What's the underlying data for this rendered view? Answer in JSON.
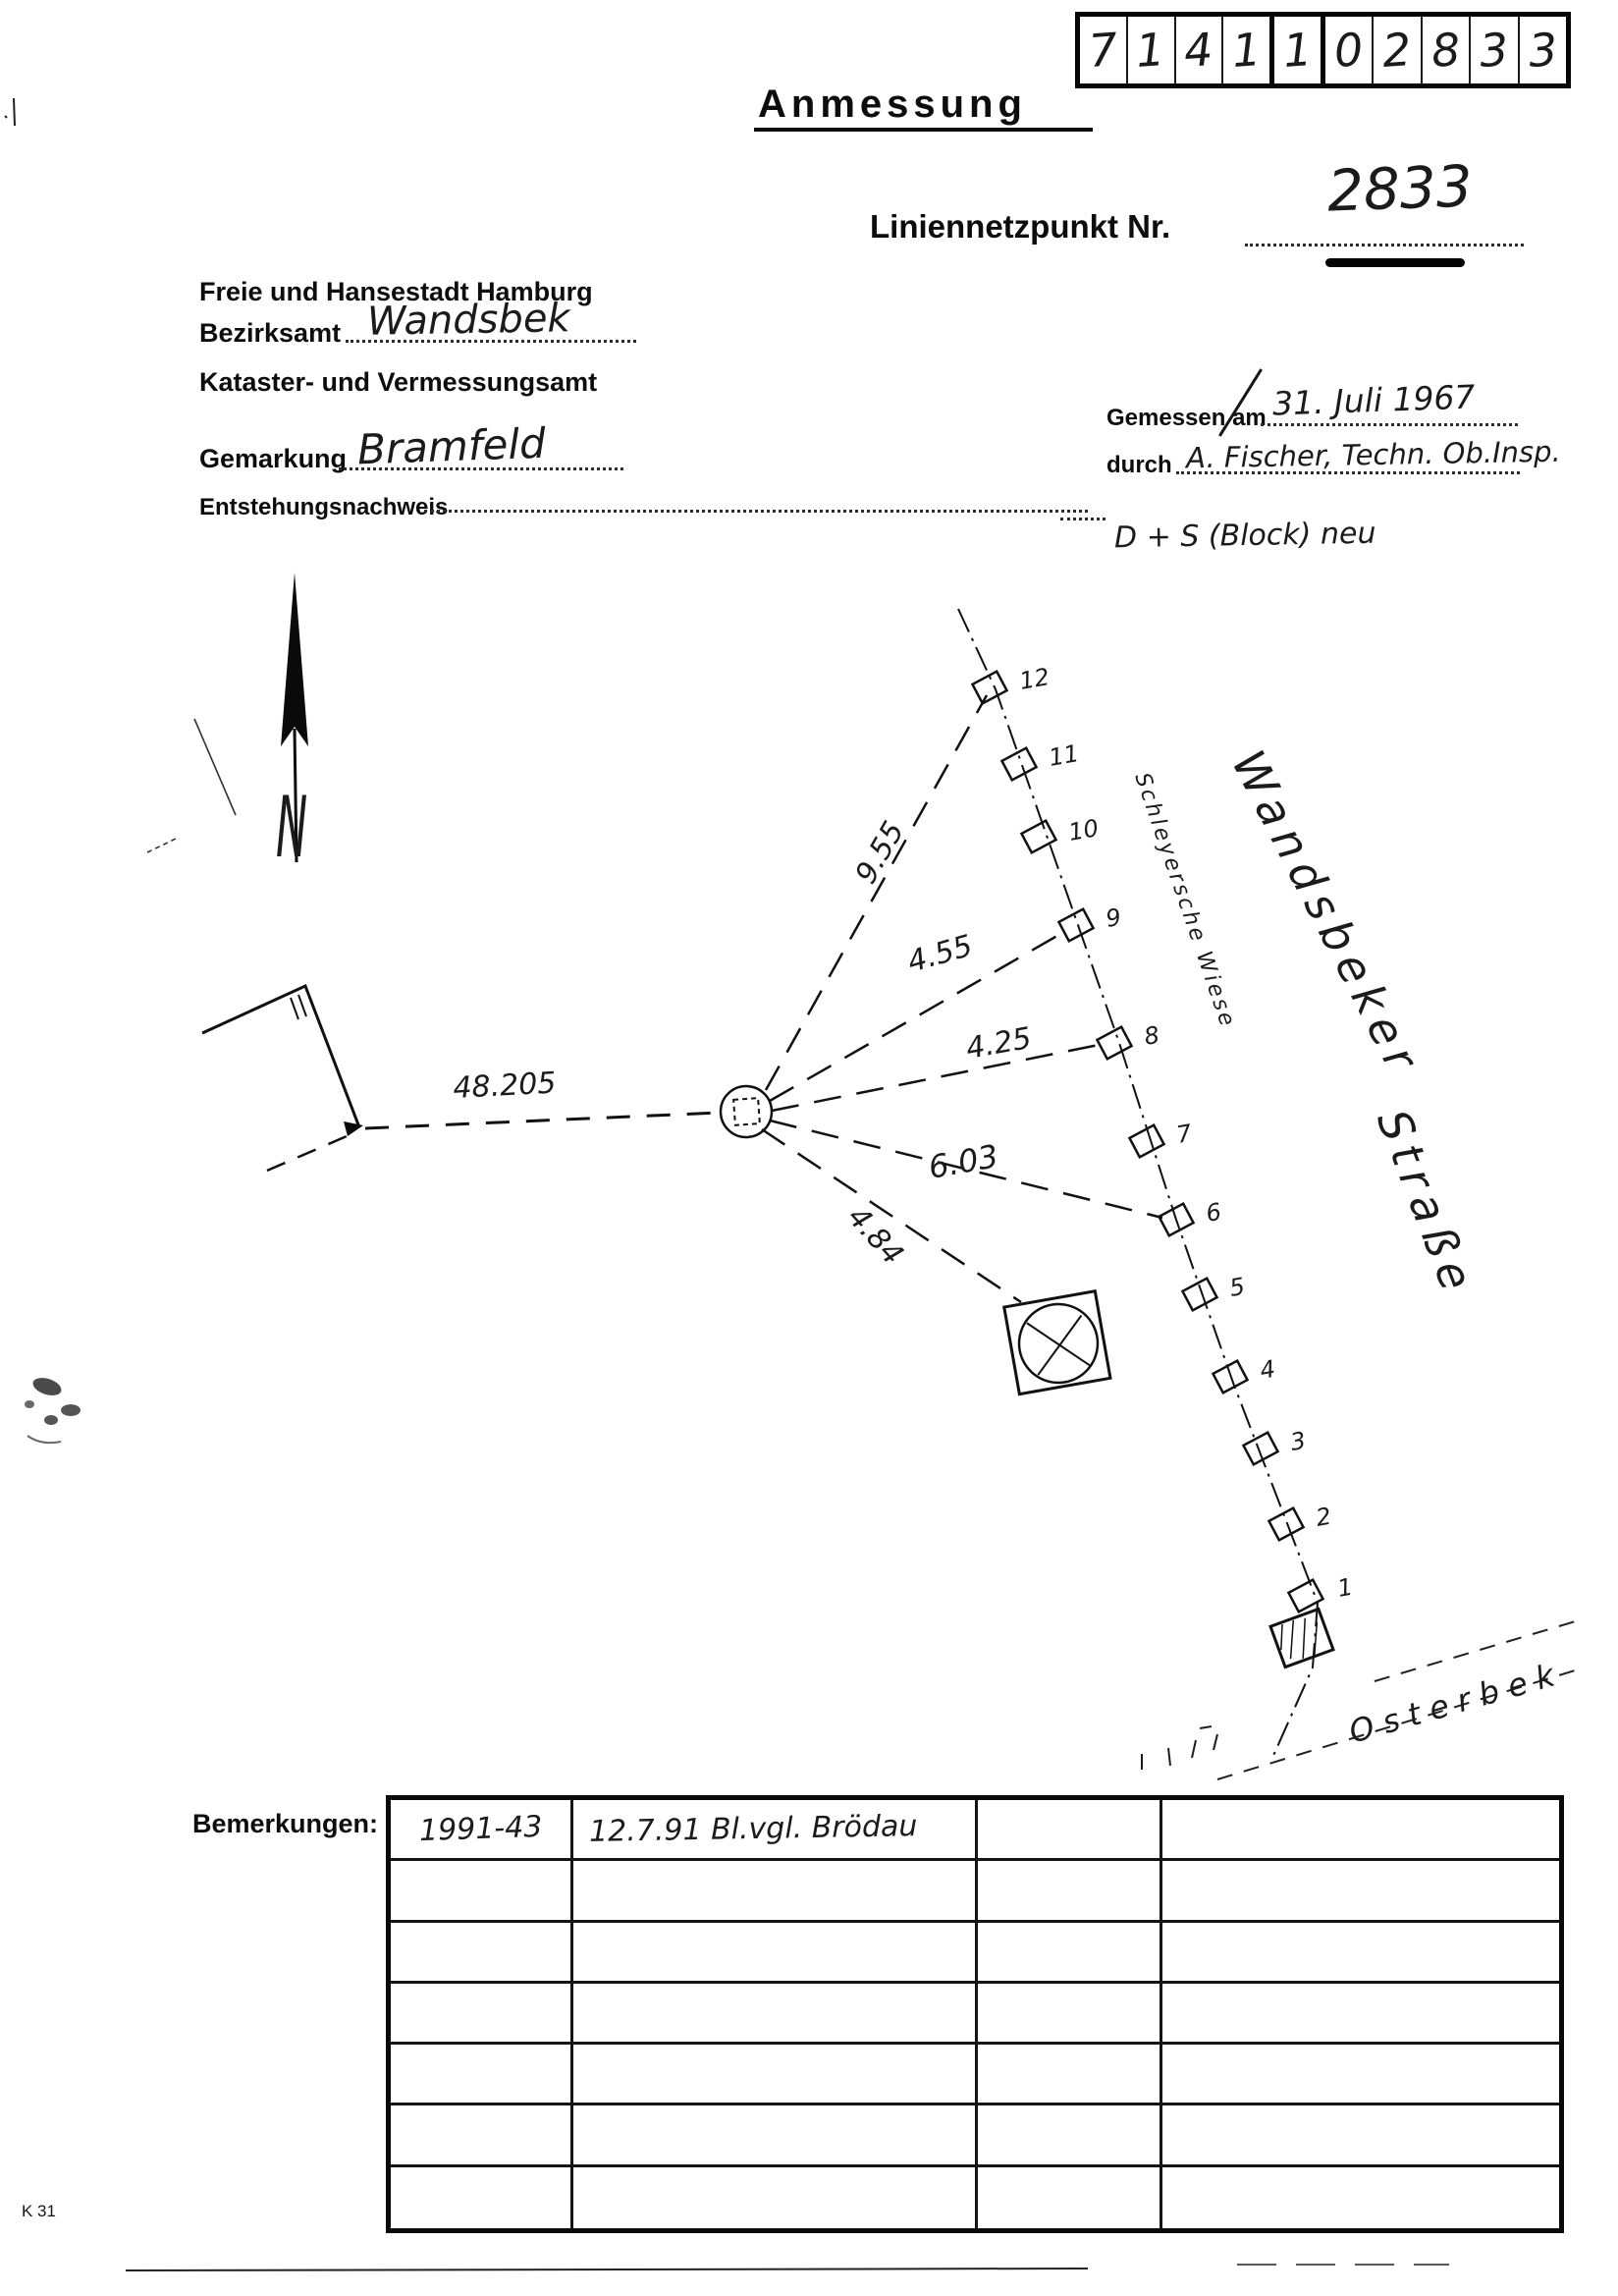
{
  "page": {
    "form_code": "K 31"
  },
  "header": {
    "title": "Anmessung",
    "id_boxes": {
      "group1": [
        "7",
        "1",
        "4",
        "1"
      ],
      "group2": [
        "1"
      ],
      "group3": [
        "0",
        "2",
        "8",
        "3",
        "3"
      ]
    },
    "point": {
      "label": "Liniennetzpunkt Nr.",
      "value": "2833"
    },
    "agency": {
      "city": "Freie und Hansestadt Hamburg",
      "district_label": "Bezirksamt",
      "district_value": "Wandsbek",
      "office": "Kataster- und Vermessungsamt",
      "gemarkung_label": "Gemarkung",
      "gemarkung_value": "Bramfeld",
      "origin_label": "Entstehungsnachweis"
    },
    "measurement": {
      "measured_on_label": "Gemessen am",
      "measured_on_value": "31. Juli 1967",
      "by_label": "durch",
      "by_value": "A. Fischer, Techn. Ob.Insp.",
      "note": "D + S (Block) neu"
    }
  },
  "sketch": {
    "north_label": "N",
    "street_name_line1": "Wandsbeker",
    "street_name_line2": "Straße",
    "creek_name": "Osterbek",
    "boundary_annotation": "Schleyersche Wiese",
    "distances": {
      "to_building": "48.205",
      "to_point_12": "9.55",
      "to_point_9": "4.55",
      "to_point_8": "4.25",
      "to_point_6": "6.03",
      "to_manhole": "4.84"
    },
    "point_numbers": [
      "12",
      "11",
      "10",
      "9",
      "8",
      "7",
      "6",
      "5",
      "4",
      "3",
      "2",
      "1"
    ]
  },
  "remarks": {
    "label": "Bemerkungen:",
    "rows": [
      [
        "1991-43",
        "12.7.91 Bl.vgl. Brödau",
        "",
        ""
      ],
      [
        "",
        "",
        "",
        ""
      ],
      [
        "",
        "",
        "",
        ""
      ],
      [
        "",
        "",
        "",
        ""
      ],
      [
        "",
        "",
        "",
        ""
      ],
      [
        "",
        "",
        "",
        ""
      ],
      [
        "",
        "",
        "",
        ""
      ]
    ]
  }
}
